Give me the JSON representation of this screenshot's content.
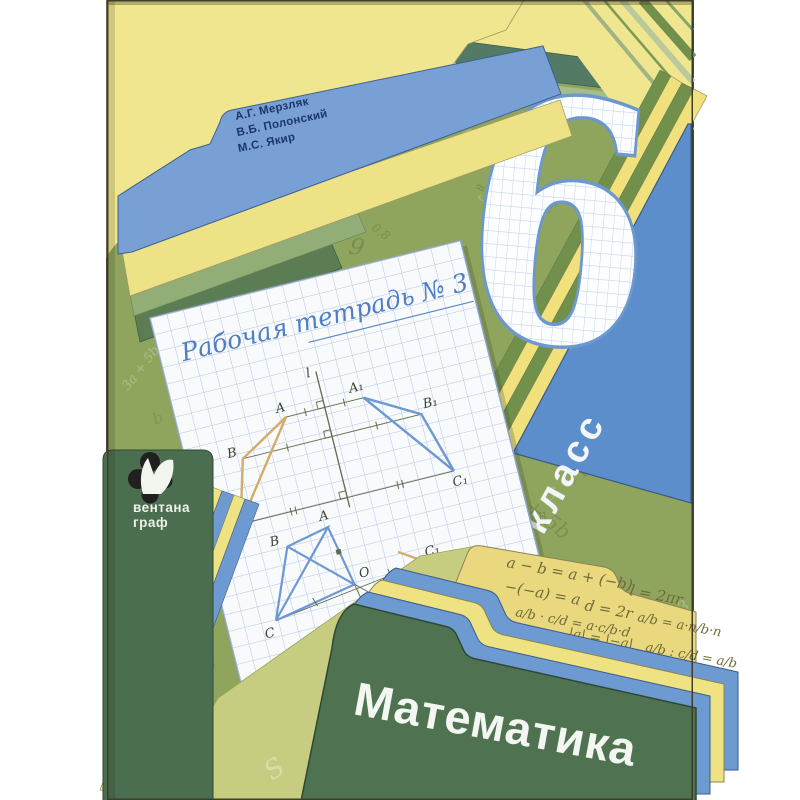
{
  "cover": {
    "authors": {
      "line1": "А.Г. Мерзляк",
      "line2": "В.Б. Полонский",
      "line3": "М.С. Якир"
    },
    "grade": {
      "number": "6",
      "label": "класс"
    },
    "notebook_title": "Рабочая тетрадь № 3",
    "subject_title": "Математика",
    "publisher": {
      "line1": "вентана",
      "line2": "граф"
    },
    "figure1": {
      "axis_label": "l",
      "a": "A",
      "b": "B",
      "c": "C",
      "a1": "A₁",
      "b1": "B₁",
      "c1": "C₁"
    },
    "figure2": {
      "a": "A",
      "b": "B",
      "c": "C",
      "o": "O",
      "c1": "C₁"
    },
    "formulas": {
      "f1": "a − b = a + (−b)",
      "f2": "−(−a) = a",
      "f3": "l = 2πr",
      "f4": "d = 2r",
      "f5": "a/b · c/d = a·c/b·d",
      "f6": "|a| = |−a|",
      "f7": "a/b = a·n/b·n",
      "f8": "a/b : c/d = a/b"
    },
    "doodles": [
      "3,2",
      "12",
      "MON",
      "∠ABC",
      "0,8",
      "189,3",
      "9",
      "S",
      "C",
      "120",
      "3a + 5b",
      "m",
      "x",
      "π",
      "D",
      "8",
      "0,7",
      "√",
      "5",
      "=",
      "|a|",
      "2",
      "b",
      "7",
      "Δ",
      "a",
      "∠B",
      "1/2",
      "≈",
      "6"
    ],
    "chartreuse_doodles": [
      "∠ABC",
      "MON",
      "0,8",
      "9",
      "√",
      "S",
      "C",
      "12"
    ]
  }
}
